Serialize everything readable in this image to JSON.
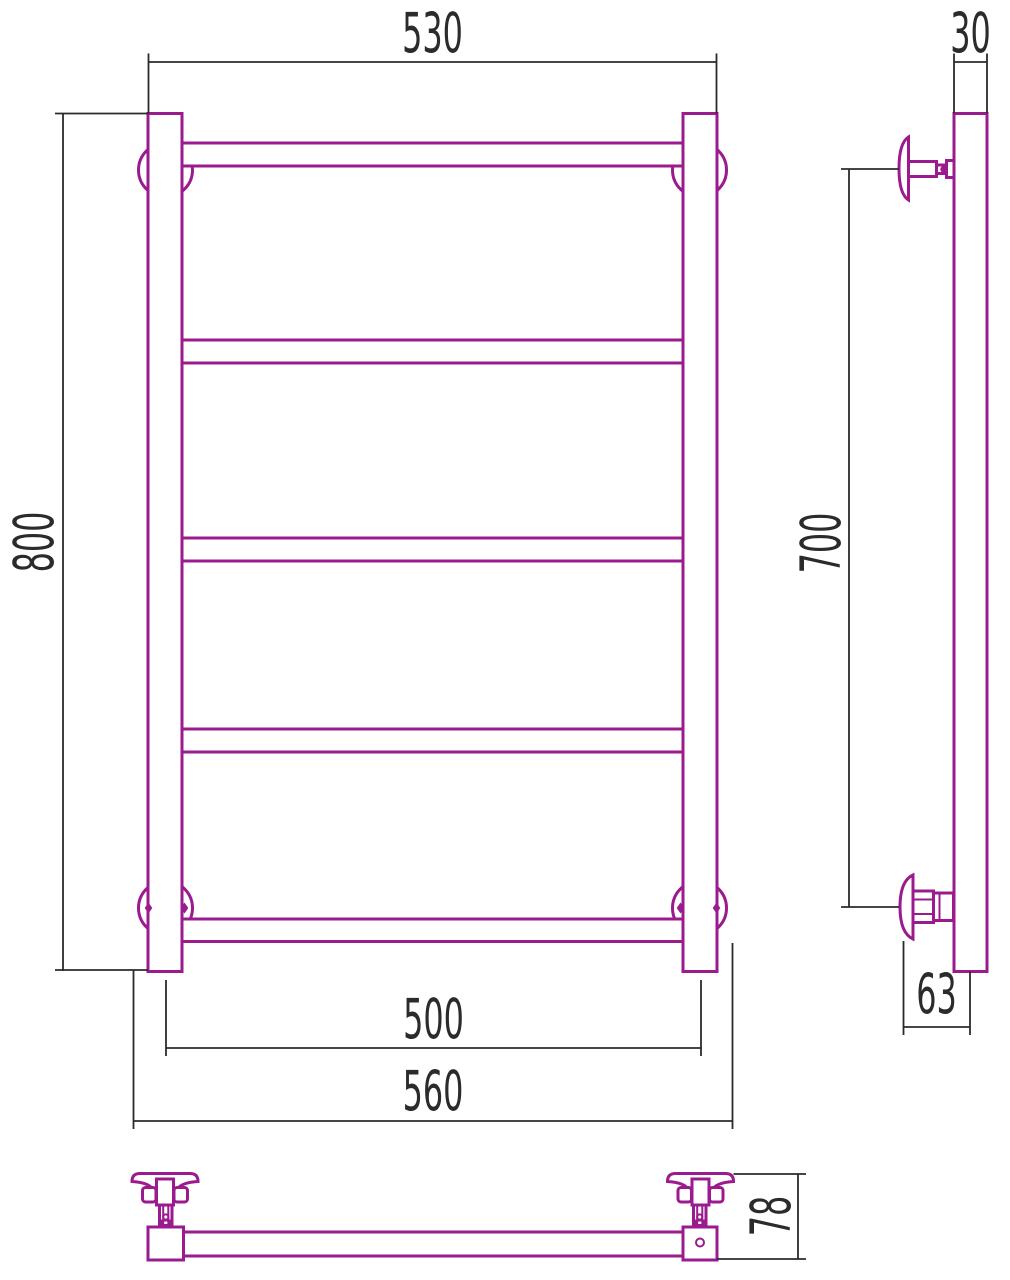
{
  "drawing": {
    "kind": "towel-rail-technical-drawing",
    "dimensions": {
      "front_width_top": "530",
      "front_height": "800",
      "front_axis_width": "500",
      "front_overall_width": "560",
      "side_tube_depth": "30",
      "side_bracket_span": "700",
      "side_wall_offset": "63",
      "bottom_depth": "78"
    },
    "colors": {
      "product_outline": "#9B1B8F",
      "dimension_lines": "#2B2B2B",
      "background": "#FFFFFF"
    }
  }
}
